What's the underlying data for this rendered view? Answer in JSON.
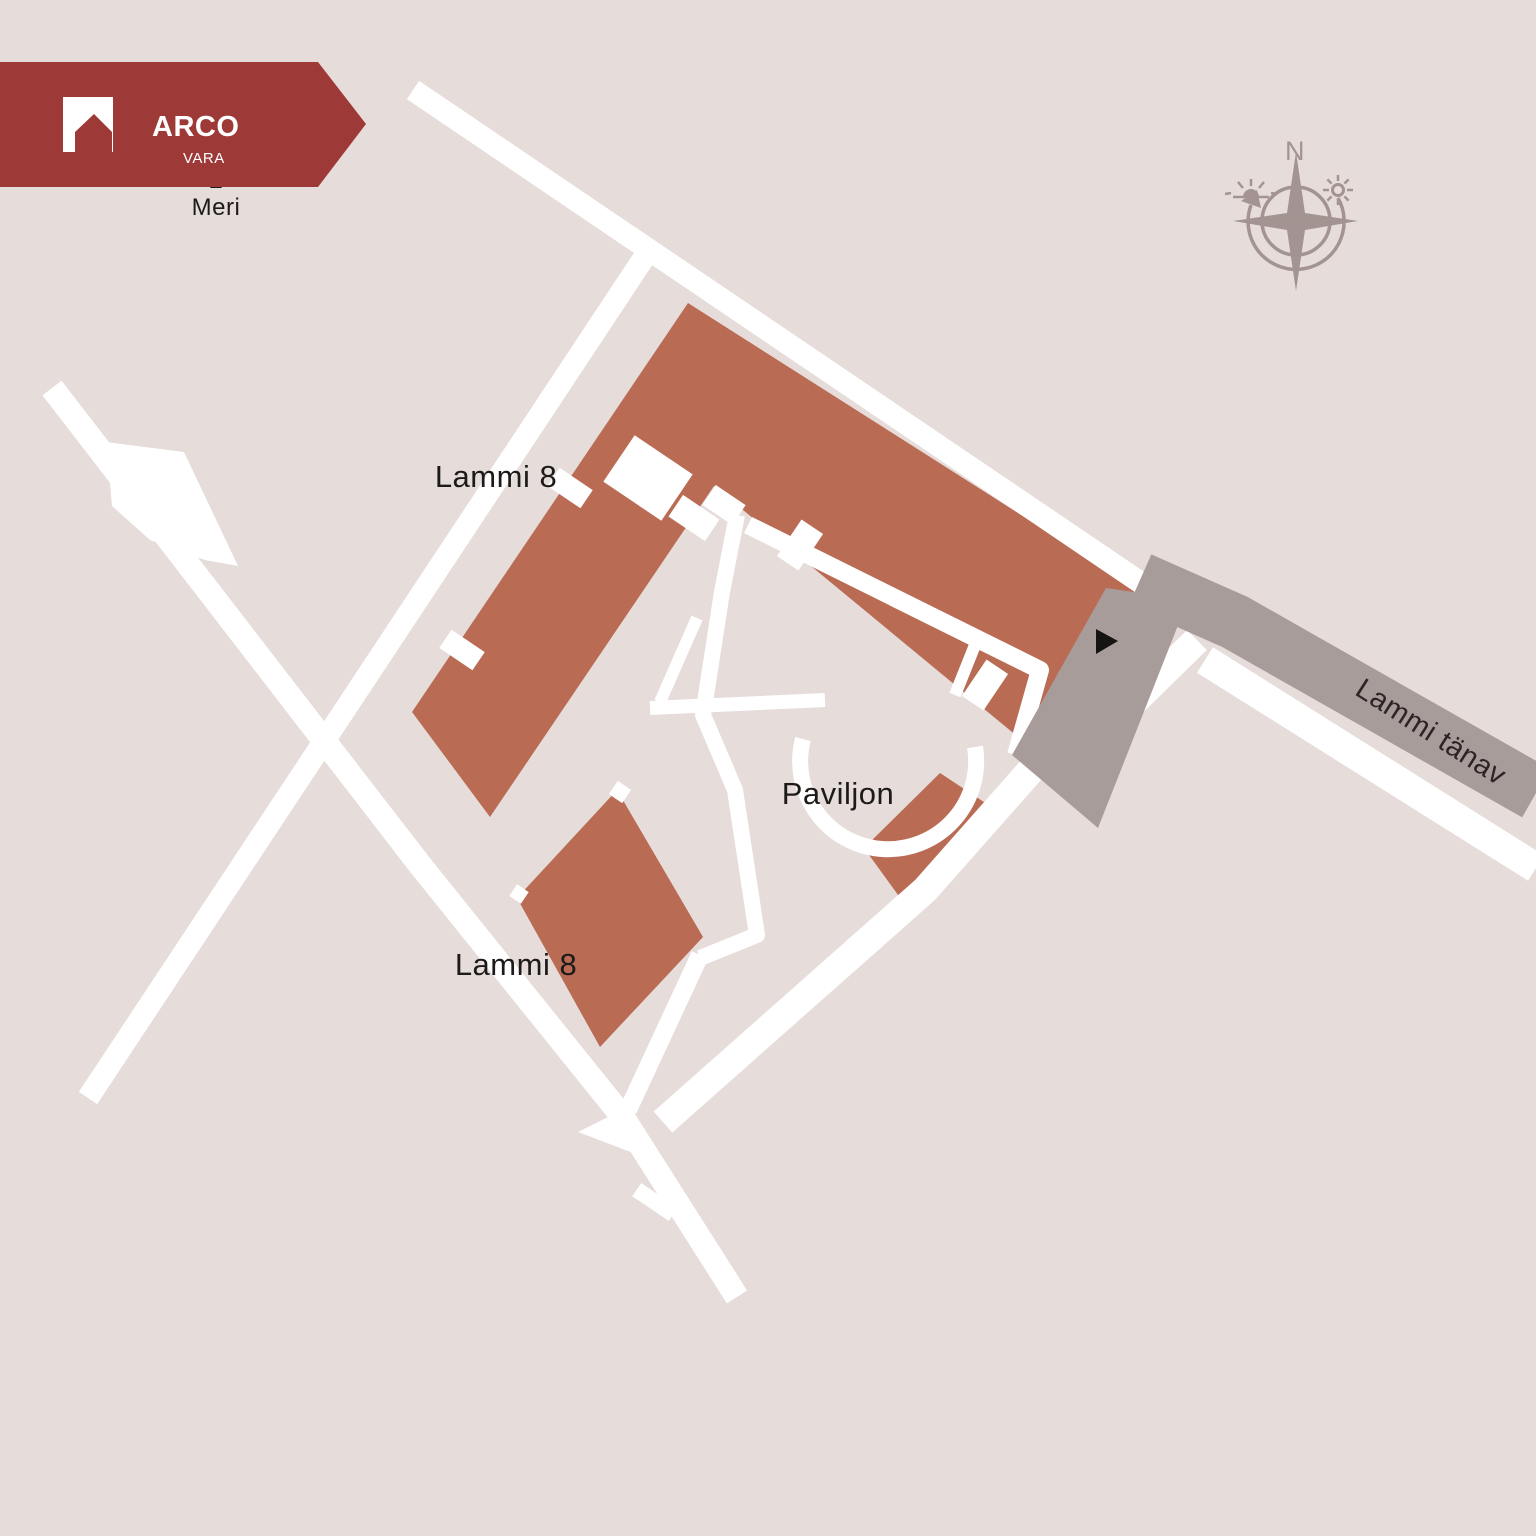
{
  "banner": {
    "brand": "ARCO",
    "subbrand": "VARA"
  },
  "labels": {
    "sea": "Meri",
    "north": "N",
    "street": "Lammi tänav",
    "lammi_upper": "Lammi 8",
    "lammi_lower": "Lammi 8",
    "pavilion": "Paviljon"
  },
  "colors": {
    "background": "#e6dcda",
    "building": "#b96b53",
    "road_white": "#ffffff",
    "road_gray": "#a89c9b",
    "parking_gray": "#a89c9b",
    "banner_red": "#9d3a38",
    "logo_white": "#ffffff",
    "marker_black": "#161412",
    "text_dark": "#1d1b1a",
    "street_text": "#2b2523",
    "compass_gray": "#a39492"
  },
  "icons": {
    "logo": "house-icon",
    "compass": "compass-rose-icon",
    "compass_sun_right": "sun-icon",
    "compass_sun_left": "sunrise-icon",
    "compass_arrow": "rotation-arrow-icon",
    "sea_arrow": "sea-direction-arrow-icon",
    "entrance": "entrance-marker-icon"
  }
}
